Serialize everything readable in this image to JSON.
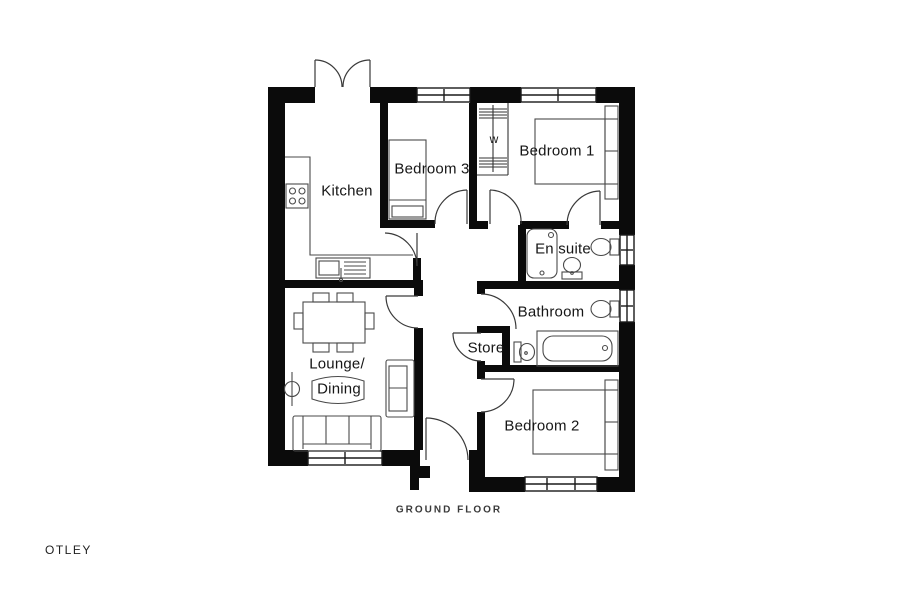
{
  "plan_title": "OTLEY",
  "floor_label": "GROUND FLOOR",
  "rooms": {
    "kitchen": "Kitchen",
    "bedroom3": "Bedroom 3",
    "bedroom1": "Bedroom 1",
    "wardrobe": "w",
    "ensuite": "En suite",
    "bathroom": "Bathroom",
    "store": "Store",
    "lounge_line1": "Lounge/",
    "lounge_line2": "Dining",
    "bedroom2": "Bedroom 2"
  },
  "fixtures": [
    "hob",
    "kitchen-sink-drainer",
    "dining-table-six-chairs",
    "sofa",
    "loveseat",
    "floor-lamp",
    "single-bed",
    "double-bed",
    "wardrobe-rails",
    "shower",
    "wash-basin",
    "toilet",
    "bath",
    "french-doors",
    "front-door"
  ],
  "colors": {
    "background": "#ffffff",
    "wall": "#0b0b0b",
    "furniture_line": "#4a4a4a",
    "door_arc": "#3a3a3a",
    "text": "#161616"
  }
}
